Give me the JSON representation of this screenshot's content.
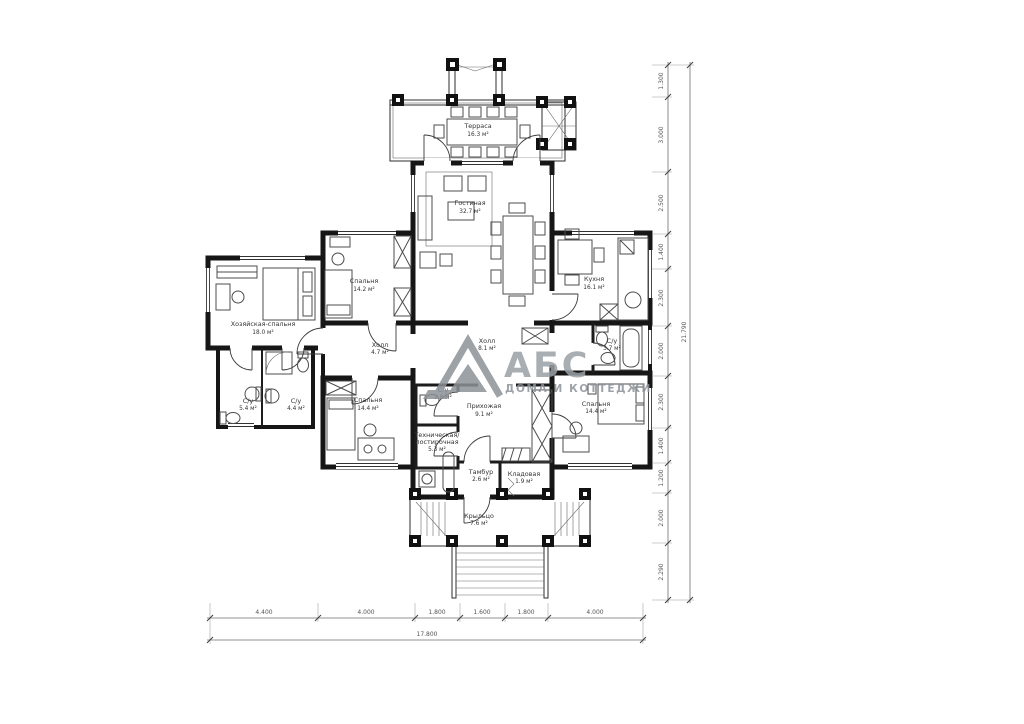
{
  "rooms": [
    {
      "name": "Терраса",
      "area": "16.3 м²"
    },
    {
      "name": "Гостиная",
      "area": "32.7 м²"
    },
    {
      "name": "Кухня",
      "area": "16.1 м²"
    },
    {
      "name": "Спальня",
      "area": "14.2 м²"
    },
    {
      "name": "Хозяйская-спальня",
      "area": "18.0 м²"
    },
    {
      "name": "Холл",
      "area": "4.7 м²"
    },
    {
      "name": "Холл",
      "area": "8.1 м²"
    },
    {
      "name": "С/у",
      "area": "2.8 м²"
    },
    {
      "name": "С/у",
      "area": "5.4 м²"
    },
    {
      "name": "С/у",
      "area": "4.4 м²"
    },
    {
      "name": "Спальня",
      "area": "14.4 м²"
    },
    {
      "name": "Прихожая",
      "area": "9.1 м²"
    },
    {
      "name": "Техническая/",
      "name2": "постирочная",
      "area": "5.3 м²"
    },
    {
      "name": "Тамбур",
      "area": "2.6 м²"
    },
    {
      "name": "Кладовая",
      "area": "1.9 м²"
    },
    {
      "name": "С/у",
      "area": "3.7 м²"
    },
    {
      "name": "Спальня",
      "area": "14.4 м²"
    },
    {
      "name": "Крыльцо",
      "area": "7.6 м²"
    }
  ],
  "logo": {
    "name": "АБС",
    "tagline": "ДОМА И КОТТЕДЖИ"
  },
  "dimensions": {
    "right": [
      "1.300",
      "3.000",
      "2.500",
      "1.400",
      "2.300",
      "2.000",
      "2.300",
      "1.400",
      "1.200",
      "2.000",
      "2.290"
    ],
    "right_total": "21.790",
    "bottom": [
      "4.400",
      "4.000",
      "1.800",
      "1.600",
      "1.800",
      "4.000"
    ],
    "bottom_total": "17.800"
  },
  "colors": {
    "ink": "#161616",
    "watermark": "#9aa0a5",
    "dim_text": "#555555"
  }
}
